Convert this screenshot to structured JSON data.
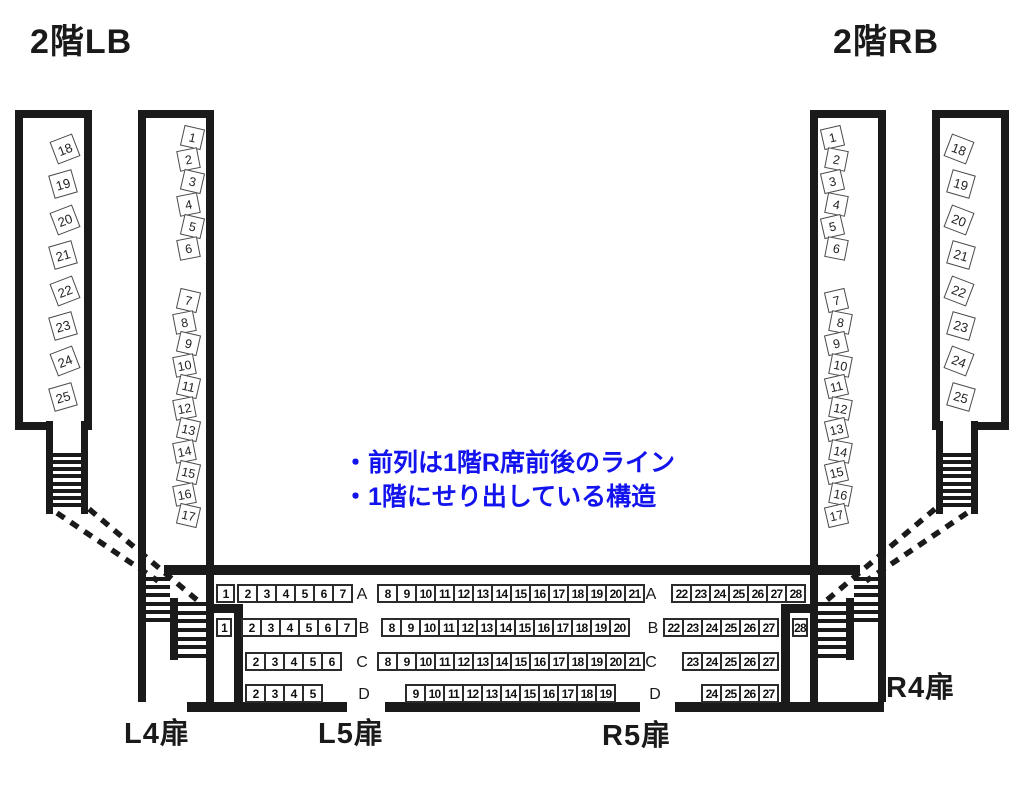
{
  "colors": {
    "ink": "#1a1a1a",
    "note_blue": "#1313ee",
    "seat_border": "#4a4a4a",
    "box_border": "#2b2b2b"
  },
  "titles": {
    "balcony_left": "2階LB",
    "balcony_right": "2階RB"
  },
  "doors": {
    "l4": "L4扉",
    "l5": "L5扉",
    "r5": "R5扉",
    "r4": "R4扉"
  },
  "notes": {
    "line1": "・前列は1階R席前後のライン",
    "line2": "・1階にせり出している構造"
  },
  "lb": {
    "outer": [
      "18",
      "19",
      "20",
      "21",
      "22",
      "23",
      "24",
      "25"
    ],
    "inner_front": [
      "1",
      "2",
      "3",
      "4",
      "5",
      "6"
    ],
    "inner_rear": [
      "7",
      "8",
      "9",
      "10",
      "11",
      "12",
      "13",
      "14",
      "15",
      "16",
      "17"
    ]
  },
  "rb": {
    "outer": [
      "18",
      "19",
      "20",
      "21",
      "22",
      "23",
      "24",
      "25"
    ],
    "inner_front": [
      "1",
      "2",
      "3",
      "4",
      "5",
      "6"
    ],
    "inner_rear": [
      "7",
      "8",
      "9",
      "10",
      "11",
      "12",
      "13",
      "14",
      "15",
      "16",
      "17"
    ]
  },
  "rows": {
    "a": {
      "label": "A",
      "left_single": "1",
      "left": [
        "2",
        "3",
        "4",
        "5",
        "6",
        "7"
      ],
      "mid": [
        "8",
        "9",
        "10",
        "11",
        "12",
        "13",
        "14",
        "15",
        "16",
        "17",
        "18",
        "19",
        "20",
        "21"
      ],
      "right": [
        "22",
        "23",
        "24",
        "25",
        "26",
        "27",
        "28"
      ]
    },
    "b": {
      "label": "B",
      "left_single": "1",
      "left": [
        "2",
        "3",
        "4",
        "5",
        "6",
        "7"
      ],
      "mid": [
        "8",
        "9",
        "10",
        "11",
        "12",
        "13",
        "14",
        "15",
        "16",
        "17",
        "18",
        "19",
        "20"
      ],
      "right": [
        "22",
        "23",
        "24",
        "25",
        "26",
        "27"
      ],
      "right_single": "28"
    },
    "c": {
      "label": "C",
      "left": [
        "2",
        "3",
        "4",
        "5",
        "6"
      ],
      "mid": [
        "8",
        "9",
        "10",
        "11",
        "12",
        "13",
        "14",
        "15",
        "16",
        "17",
        "18",
        "19",
        "20",
        "21"
      ],
      "right": [
        "23",
        "24",
        "25",
        "26",
        "27"
      ]
    },
    "d": {
      "label": "D",
      "left": [
        "2",
        "3",
        "4",
        "5"
      ],
      "mid": [
        "9",
        "10",
        "11",
        "12",
        "13",
        "14",
        "15",
        "16",
        "17",
        "18",
        "19"
      ],
      "right": [
        "24",
        "25",
        "26",
        "27"
      ]
    }
  }
}
